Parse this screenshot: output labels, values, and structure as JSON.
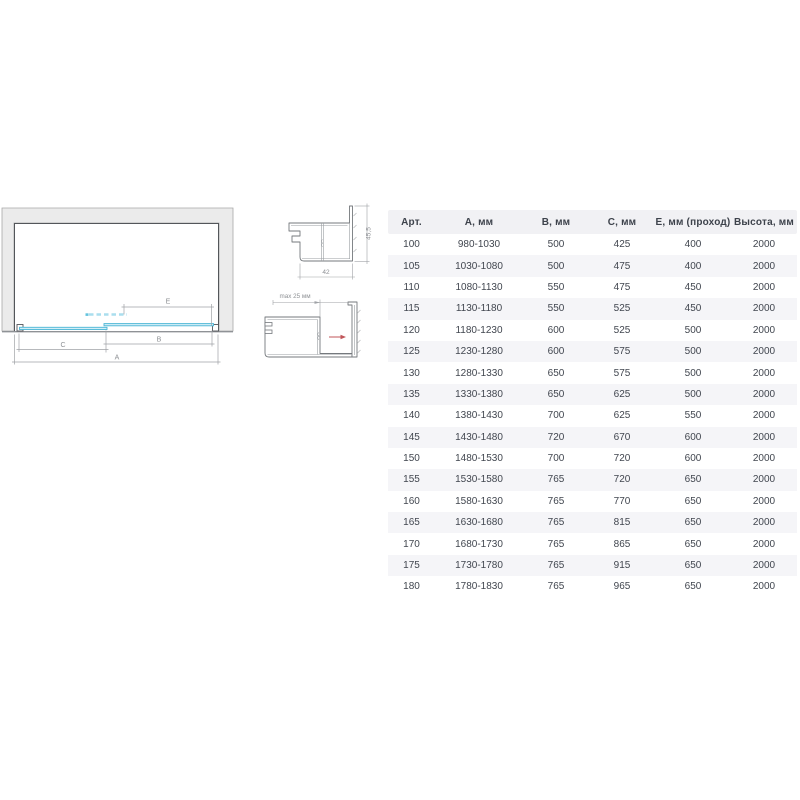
{
  "diagram": {
    "dim_labels": {
      "a": "A",
      "b": "B",
      "c": "C",
      "e": "E"
    },
    "profile_top": {
      "width_label": "42",
      "height_label": "45,5"
    },
    "profile_side": {
      "max_label": "max 25 мм"
    },
    "colors": {
      "wall_fill": "#ebebeb",
      "wall_border": "#a8a8a8",
      "frame_line": "#4d5156",
      "glass_stroke": "#4ab5d5",
      "glass_fill": "#d2eef7",
      "glass_dashed": "#aadeee",
      "dimension_line": "#9fa2a6",
      "dimension_text": "#8d9094",
      "adjustment_arrow_red": "#c1565a"
    }
  },
  "table": {
    "header_bg": "#f1f1f4",
    "stripe_bg": "#f5f5f8",
    "headers": [
      "Арт.",
      "А, мм",
      "В, мм",
      "С, мм",
      "Е, мм (проход)",
      "Высота, мм"
    ],
    "rows": [
      [
        "100",
        "980-1030",
        "500",
        "425",
        "400",
        "2000"
      ],
      [
        "105",
        "1030-1080",
        "500",
        "475",
        "400",
        "2000"
      ],
      [
        "110",
        "1080-1130",
        "550",
        "475",
        "450",
        "2000"
      ],
      [
        "115",
        "1130-1180",
        "550",
        "525",
        "450",
        "2000"
      ],
      [
        "120",
        "1180-1230",
        "600",
        "525",
        "500",
        "2000"
      ],
      [
        "125",
        "1230-1280",
        "600",
        "575",
        "500",
        "2000"
      ],
      [
        "130",
        "1280-1330",
        "650",
        "575",
        "500",
        "2000"
      ],
      [
        "135",
        "1330-1380",
        "650",
        "625",
        "500",
        "2000"
      ],
      [
        "140",
        "1380-1430",
        "700",
        "625",
        "550",
        "2000"
      ],
      [
        "145",
        "1430-1480",
        "720",
        "670",
        "600",
        "2000"
      ],
      [
        "150",
        "1480-1530",
        "700",
        "720",
        "600",
        "2000"
      ],
      [
        "155",
        "1530-1580",
        "765",
        "720",
        "650",
        "2000"
      ],
      [
        "160",
        "1580-1630",
        "765",
        "770",
        "650",
        "2000"
      ],
      [
        "165",
        "1630-1680",
        "765",
        "815",
        "650",
        "2000"
      ],
      [
        "170",
        "1680-1730",
        "765",
        "865",
        "650",
        "2000"
      ],
      [
        "175",
        "1730-1780",
        "765",
        "915",
        "650",
        "2000"
      ],
      [
        "180",
        "1780-1830",
        "765",
        "965",
        "650",
        "2000"
      ]
    ]
  }
}
